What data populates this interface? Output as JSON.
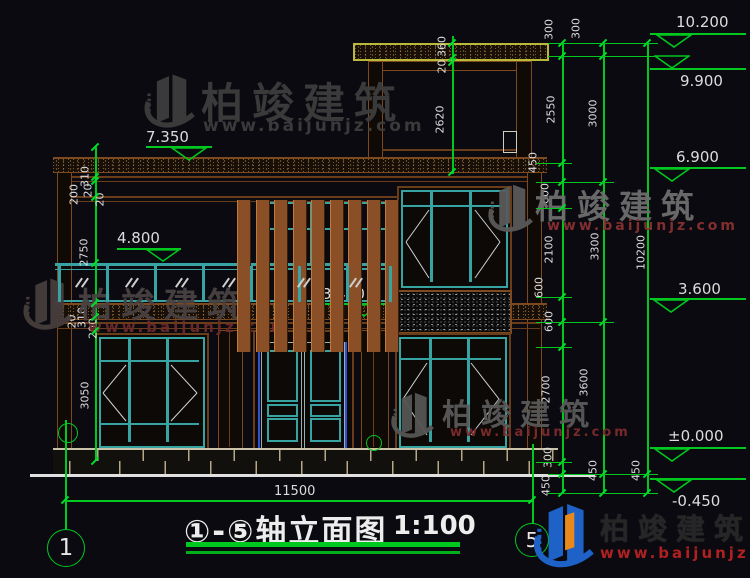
{
  "watermark": {
    "brand": "柏竣建筑",
    "site": "www.baijunjz.com"
  },
  "title_block": {
    "title": "①-⑤轴立面图",
    "scale": "1:100"
  },
  "axis_bubbles": {
    "left": "1",
    "right": "5"
  },
  "dimensions": {
    "overall_width": "11500",
    "right_chain_inner": [
      "300",
      "2550",
      "450",
      "600",
      "2100",
      "600",
      "600",
      "2700",
      "300",
      "450"
    ],
    "right_chain_middle": [
      "300",
      "3000",
      "3300",
      "3600",
      "450"
    ],
    "right_chain_outer": [
      "10200",
      "450"
    ],
    "left_upper_group": [
      "310",
      "200",
      "20",
      "20"
    ],
    "left_floor_heights": [
      "2750",
      "3050"
    ],
    "left_slab_group": [
      "20",
      "310",
      "200"
    ],
    "penthouse_group": [
      "360",
      "20",
      "2620"
    ]
  },
  "elevations": {
    "right": [
      "10.200",
      "9.900",
      "6.900",
      "3.600",
      "±0.000",
      "-0.450"
    ],
    "left": [
      "7.350",
      "4.800",
      "3.440"
    ]
  }
}
